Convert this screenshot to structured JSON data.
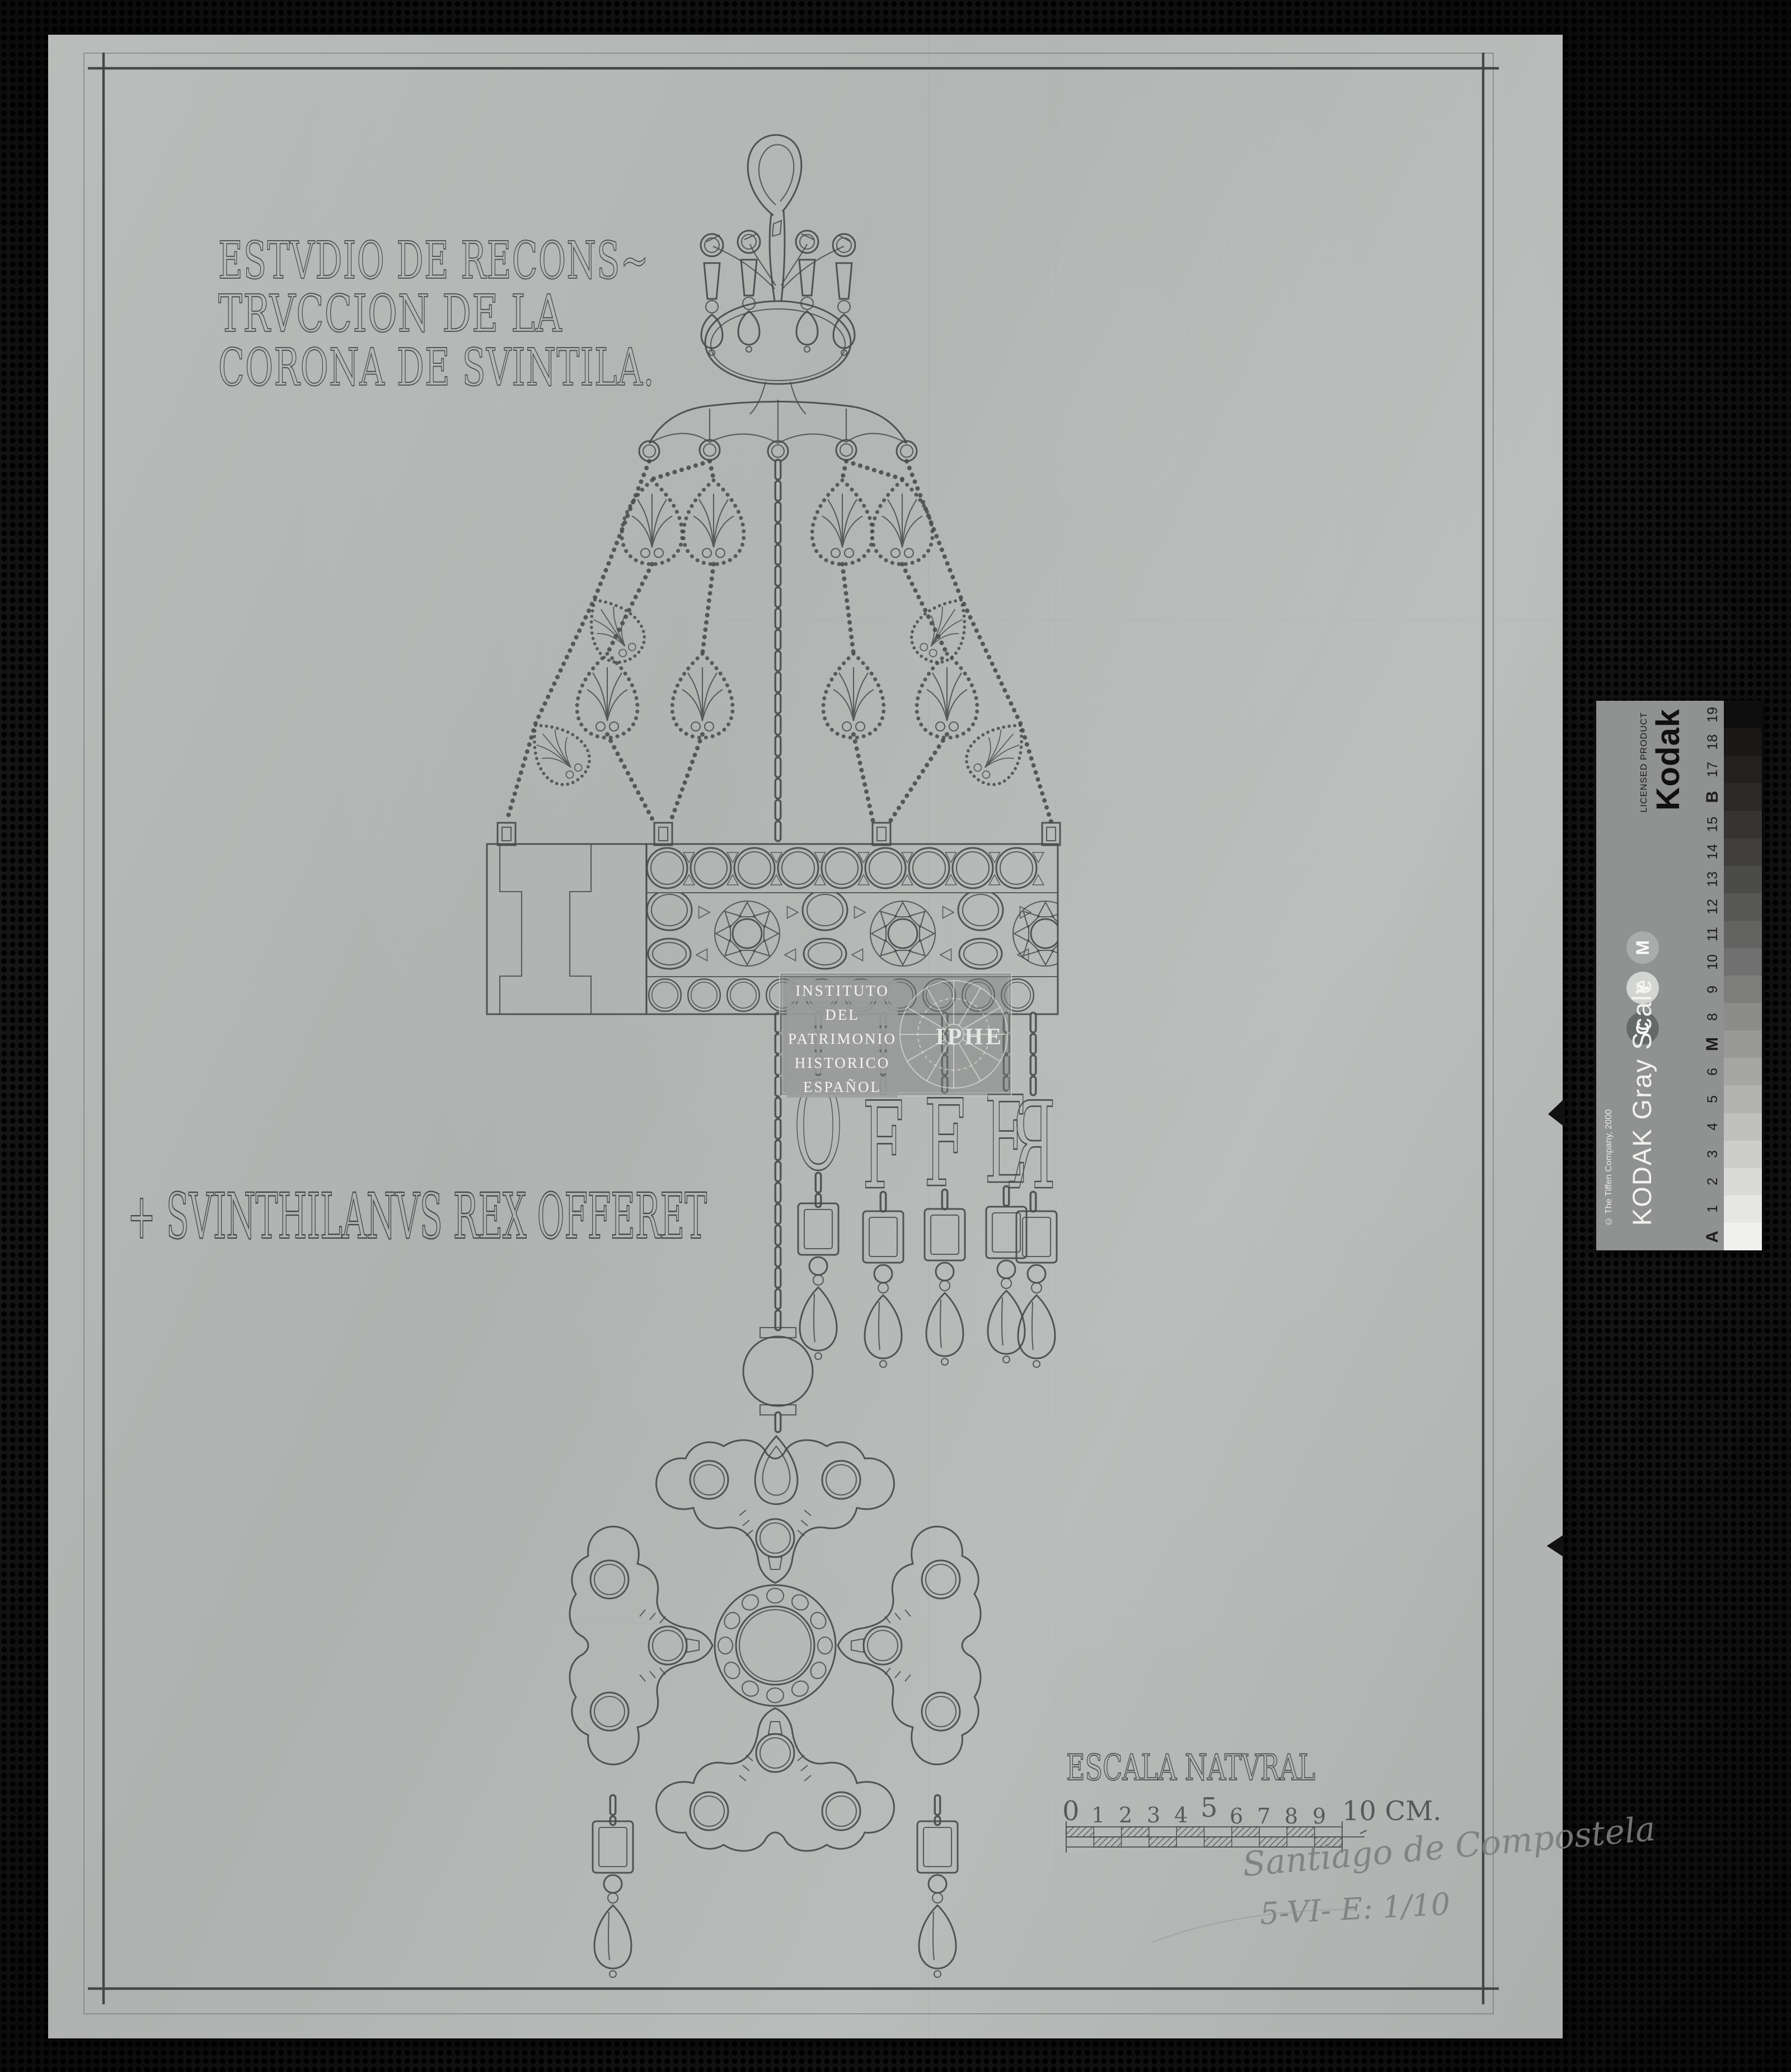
{
  "photo": {
    "backdrop_color": "#161616",
    "paper_color": "#b6b9b7",
    "ink_color": "#474b49",
    "pencil_color": "#7b7f7d"
  },
  "title_block": {
    "lines": [
      "ESTVDIO DE RECONS~",
      "TRVCCION DE LA",
      "CORONA DE SVINTILA."
    ]
  },
  "inscription": "+ SVINTHILANVS REX OFFERET",
  "pendant_letters": [
    "O",
    "F",
    "F",
    "E",
    "R"
  ],
  "scale_label": "ESCALA NATVRAL",
  "ruler": {
    "ticks": [
      "0",
      "1",
      "2",
      "3",
      "4",
      "5",
      "6",
      "7",
      "8",
      "9"
    ],
    "end_label": "10 CM."
  },
  "annotations": {
    "place": "Santiago de Compostela",
    "date_scale": "5-VI- E: 1/10"
  },
  "watermark": {
    "lines": [
      "INSTITUTO",
      "DEL",
      "PATRIMONIO",
      "HISTORICO",
      "ESPAÑOL"
    ],
    "acronym": "IPHE"
  },
  "kodak": {
    "brand": "Kodak",
    "brand_sub": "LICENSED PRODUCT",
    "scale_name": "KODAK Gray Scale",
    "copyright": "© The Tiffen Company, 2000",
    "bar_color": "#8f9290",
    "cmy": [
      {
        "letter": "C",
        "circle": "#646a68"
      },
      {
        "letter": "Y",
        "circle": "#d3d5d2"
      },
      {
        "letter": "M",
        "circle": "#a8acaa"
      }
    ],
    "labels": [
      "A",
      "1",
      "2",
      "3",
      "4",
      "5",
      "6",
      "M",
      "8",
      "9",
      "10",
      "11",
      "12",
      "13",
      "14",
      "15",
      "B",
      "17",
      "18",
      "19"
    ],
    "bold_labels": [
      "A",
      "M",
      "B"
    ],
    "patch_shades": [
      "#f0f0ee",
      "#e6e6e4",
      "#dadad8",
      "#cdcdcb",
      "#c0c0be",
      "#b3b3b1",
      "#a6a6a4",
      "#999997",
      "#8c8c8a",
      "#7e7e7c",
      "#707070",
      "#636361",
      "#575755",
      "#4b4b49",
      "#403f3e",
      "#353433",
      "#2b2a29",
      "#222120",
      "#191817",
      "#0f0e0e"
    ]
  }
}
